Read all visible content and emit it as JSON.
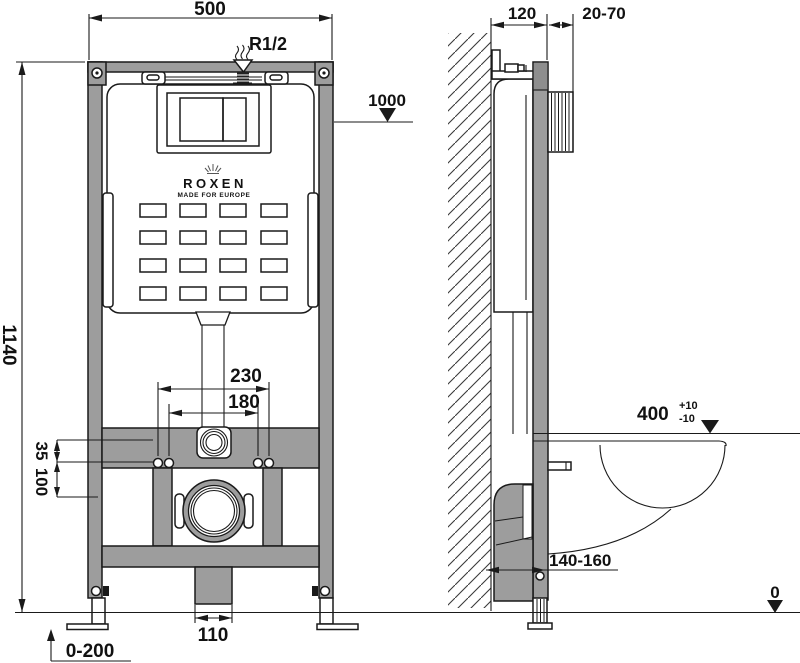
{
  "brand": {
    "name": "ROXEN",
    "tagline": "MADE FOR EUROPE"
  },
  "labels": {
    "frame_width": "500",
    "inlet_thread": "R1/2",
    "frame_height": "1140",
    "level_top": "1000",
    "stud_spacing_outer": "230",
    "stud_spacing_inner": "180",
    "offset_35": "35",
    "offset_100": "100",
    "drain_outlet_width": "110",
    "feet_adjust_range": "0-200",
    "frame_depth": "120",
    "wall_clearance": "20-70",
    "bowl_height": "400",
    "bowl_height_tol_plus": "+10",
    "bowl_height_tol_minus": "-10",
    "bottom_depth_range": "140-160",
    "floor_level": "0"
  },
  "colors": {
    "frame_gray": "#9d9d9d",
    "outline": "#1a1a1a"
  }
}
